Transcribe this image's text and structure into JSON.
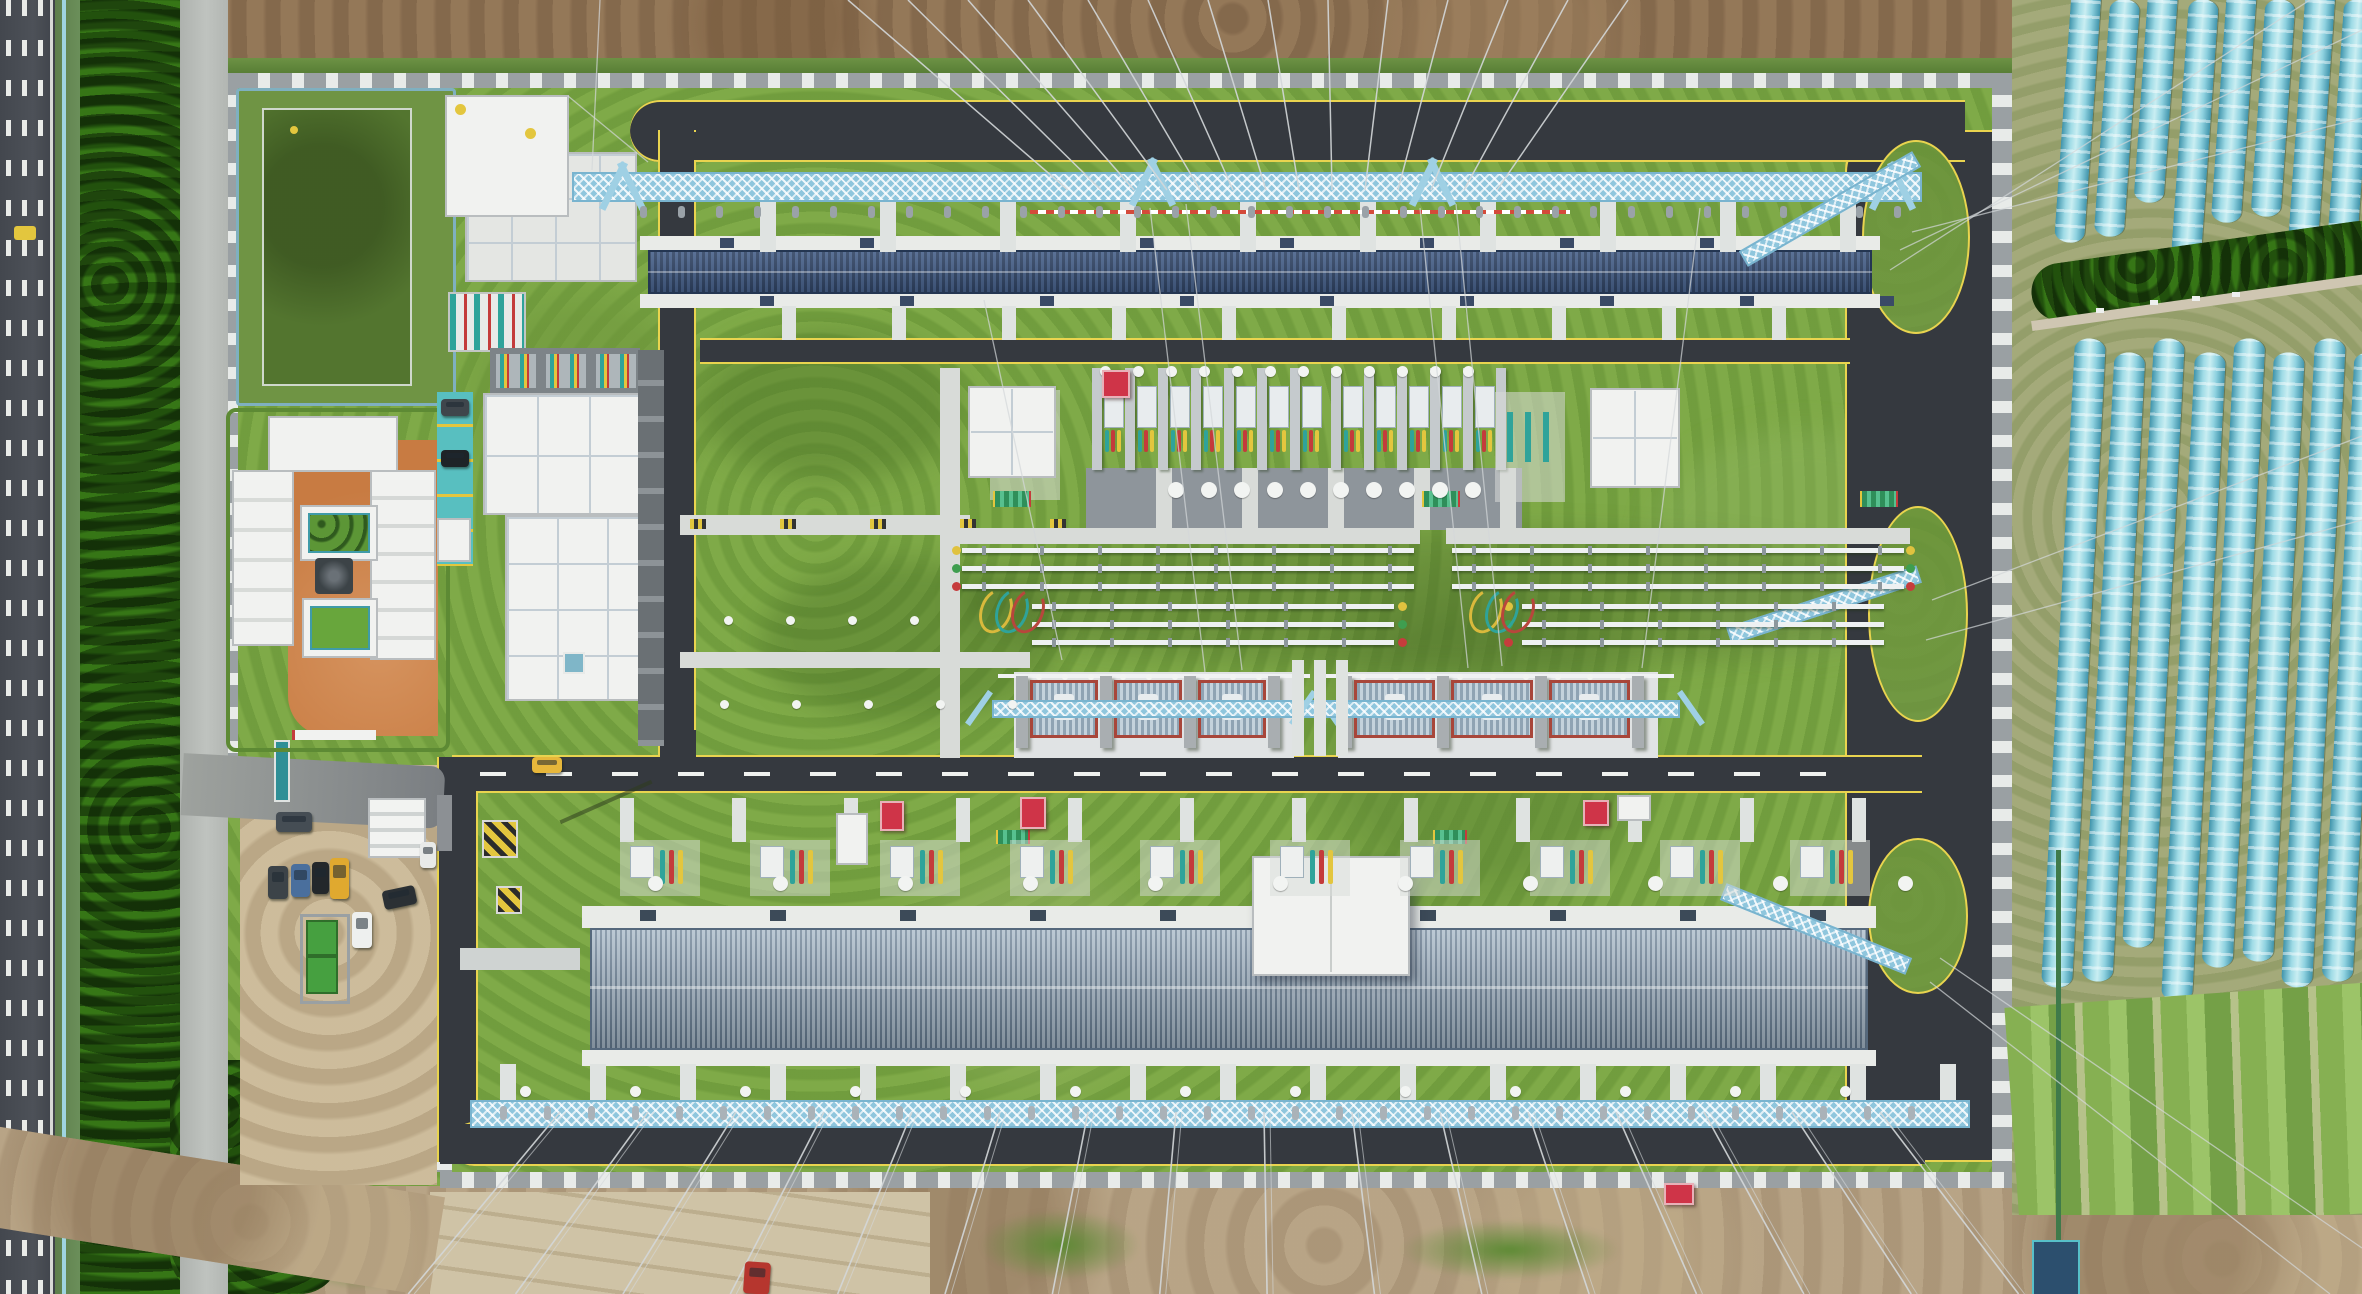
{
  "scene": {
    "type": "aerial-photograph",
    "subject": "top-down drone view of a high-voltage electrical substation compound",
    "surroundings": [
      "multi-lane highway with dashed lane markings (left)",
      "roadside tree belt",
      "light service road",
      "green retention pond",
      "courtyard staff building with two green garden pools",
      "gravel parking lot with vehicles",
      "rows of blue plastic greenhouse tunnels (right)",
      "bare earth construction ground (top and bottom)"
    ]
  },
  "palette": {
    "grass": "#7ca943",
    "asphalt": "#35393f",
    "highway": "#4a4e55",
    "curb_yellow": "#e9d44f",
    "concrete": "#d8dbd8",
    "white_roof": "#f1f2f0",
    "hall_roof_dark": "#3d5578",
    "hall_roof_light": "#8ea6ba",
    "gantry_blue": "#a8d8ea",
    "pond": "#53752f",
    "dirt_top": "#8f7355",
    "dirt_bottom": "#b5a184",
    "greenhouse": "#5fb9cf",
    "court_orange": "#c87b42",
    "parking_teal": "#58bfc0",
    "red_accent": "#cf3448",
    "busbar_white": "#eef1f2",
    "transformer_frame": "#a8463a",
    "radiator": "#9fb6c4",
    "field_green": "#86b052",
    "pool_green": "#5c9636",
    "dumpster_green": "#46a040"
  },
  "highway": {
    "dash_columns": [
      6,
      22,
      38
    ],
    "edge_line_x": 50,
    "yellow_marking": [
      14,
      226,
      22,
      14
    ]
  },
  "pond": {
    "enclosure": [
      236,
      88,
      214,
      312
    ],
    "water": [
      262,
      108,
      146,
      274
    ],
    "marker_dot": [
      290,
      126
    ]
  },
  "courtyard": {
    "ground": [
      288,
      440,
      150,
      296
    ],
    "building_top": [
      268,
      416,
      130,
      56
    ],
    "building_left": [
      232,
      470,
      58,
      172
    ],
    "building_right": [
      370,
      470,
      62,
      186
    ],
    "pool_upper": [
      300,
      505,
      74,
      52
    ],
    "pool_lower": [
      302,
      598,
      72,
      56
    ],
    "pavilion": [
      315,
      558,
      38,
      36
    ],
    "tree_dots_grid": [
      4,
      4
    ]
  },
  "teal_parking": {
    "rect": [
      437,
      392,
      36,
      174
    ],
    "lane_lines": 5
  },
  "office": {
    "roof_upper": [
      483,
      393,
      158,
      122
    ],
    "roof_lower": [
      505,
      515,
      150,
      186
    ],
    "east_wing": [
      638,
      350,
      26,
      396
    ],
    "rooftop_bays": 3,
    "bay_row": [
      490,
      348,
      150,
      46
    ],
    "skylight": [
      563,
      652,
      18,
      18
    ]
  },
  "admin_buildings": {
    "a": [
      445,
      95,
      124,
      122
    ],
    "b": [
      465,
      152,
      172,
      130
    ],
    "pad_c": [
      448,
      292,
      74,
      56
    ],
    "yellow_dots": [
      [
        455,
        104
      ],
      [
        525,
        128
      ]
    ]
  },
  "halls": {
    "upper": {
      "roof": [
        648,
        250,
        1224,
        44
      ],
      "band_top": [
        640,
        236,
        1240,
        14
      ],
      "band_bottom": [
        640,
        294,
        1240,
        14
      ]
    },
    "lower": {
      "roof": [
        590,
        928,
        1278,
        122
      ],
      "band_top": [
        582,
        906,
        1294,
        22
      ],
      "band_bottom": [
        582,
        1050,
        1294,
        16
      ],
      "penthouse": [
        1252,
        856,
        158,
        120
      ]
    }
  },
  "small_buildings": [
    [
      968,
      386,
      88,
      92
    ],
    [
      1590,
      388,
      90,
      100
    ]
  ],
  "switch_bays": {
    "count": 12,
    "x0": 1092,
    "step": 33,
    "y": 368,
    "divider_h": 102,
    "gap_after": 6,
    "cable_colors": [
      "#2fa39a",
      "#c43b3b",
      "#e3c63e"
    ],
    "circle_row_y": 482,
    "pad_y": 468,
    "pad_h": 62
  },
  "busbar_groups": [
    {
      "x": 962,
      "w": 452,
      "marker_side": "left"
    },
    {
      "x": 1452,
      "w": 452,
      "marker_side": "right"
    }
  ],
  "busbar": {
    "upper_ys": [
      548,
      566,
      584
    ],
    "lower_ys": [
      604,
      622,
      640
    ],
    "tube_h": 5,
    "marker_colors": [
      "#e0c23f",
      "#3f9e4f",
      "#c63c3c"
    ]
  },
  "transformer_banks": [
    {
      "x": 1028,
      "w": 252,
      "units": 3
    },
    {
      "x": 1352,
      "w": 292,
      "units": 3
    }
  ],
  "transformer": {
    "y": 672,
    "pad_h": 86,
    "unit_y": 680,
    "unit_h": 58,
    "duct_piers_x": [
      1292,
      1314,
      1336
    ]
  },
  "gantries": {
    "top": {
      "x": 572,
      "y": 172,
      "w": 1350,
      "h": 30
    },
    "bottom": {
      "x": 470,
      "y": 1100,
      "w": 1500,
      "h": 28
    },
    "island_trusses": [
      {
        "x": 1730,
        "y": 200,
        "len": 200,
        "rot": -30
      },
      {
        "x": 1724,
        "y": 596,
        "len": 200,
        "rot": -18
      },
      {
        "x": 1716,
        "y": 920,
        "len": 200,
        "rot": 22
      }
    ]
  },
  "grass_islands": [
    [
      1862,
      140,
      104,
      190
    ],
    [
      1868,
      506,
      96,
      212
    ],
    [
      1868,
      838,
      96,
      152
    ]
  ],
  "piers": {
    "rows": [
      {
        "y": 196,
        "h": 56,
        "x0": 760,
        "x1": 1900,
        "step": 120,
        "w": 16
      },
      {
        "y": 306,
        "h": 34,
        "x0": 782,
        "x1": 1880,
        "step": 110,
        "w": 14
      },
      {
        "y": 798,
        "h": 44,
        "x0": 620,
        "x1": 1900,
        "step": 112,
        "w": 14
      },
      {
        "y": 1064,
        "h": 38,
        "x0": 500,
        "x1": 1940,
        "step": 90,
        "w": 16
      }
    ]
  },
  "stones": {
    "rows": [
      {
        "y": 366,
        "x0": 1100,
        "x1": 1480,
        "step": 33,
        "d": 11
      },
      {
        "y": 482,
        "x0": 1168,
        "x1": 1470,
        "step": 33,
        "d": 16
      },
      {
        "y": 876,
        "x0": 648,
        "x1": 1900,
        "step": 125,
        "d": 15
      },
      {
        "y": 1086,
        "x0": 520,
        "x1": 1920,
        "step": 110,
        "d": 11
      },
      {
        "y": 616,
        "x0": 724,
        "x1": 950,
        "step": 62,
        "d": 9
      },
      {
        "y": 700,
        "x0": 720,
        "x1": 1010,
        "step": 72,
        "d": 9
      }
    ]
  },
  "power_lines": {
    "top_fan": {
      "count": 14,
      "x0_top": 848,
      "dx_top": 60,
      "x0_bot": 1068,
      "dx_bot": 33,
      "y_bot": 190
    },
    "bottom_fan": {
      "count": 16,
      "x0": 560,
      "dx": 88,
      "y_top": 1112,
      "center": 1250,
      "spread": 0.22
    },
    "extra": [
      [
        1900,
        250,
        2362,
        30
      ],
      [
        1890,
        270,
        2310,
        0
      ],
      [
        1912,
        232,
        2362,
        118
      ],
      [
        1932,
        600,
        2362,
        436
      ],
      [
        1926,
        640,
        2362,
        520
      ],
      [
        1940,
        958,
        2362,
        1248
      ],
      [
        1930,
        982,
        2330,
        1294
      ],
      [
        1150,
        208,
        1205,
        672
      ],
      [
        1186,
        204,
        1242,
        670
      ],
      [
        1420,
        208,
        1468,
        668
      ],
      [
        1456,
        204,
        1502,
        666
      ],
      [
        984,
        300,
        1062,
        660
      ],
      [
        1700,
        208,
        1642,
        668
      ],
      [
        568,
        96,
        648,
        162
      ],
      [
        600,
        0,
        592,
        170
      ]
    ]
  },
  "vehicles": [
    {
      "name": "yellow-car",
      "c": "#e7b73b",
      "r": [
        532,
        757,
        30,
        16
      ],
      "rot": 0
    },
    {
      "name": "gray-car",
      "c": "#454d54",
      "r": [
        276,
        812,
        36,
        20
      ],
      "rot": 0
    },
    {
      "name": "dark-car",
      "c": "#3c4348",
      "r": [
        268,
        866,
        20,
        33
      ],
      "rot": 0
    },
    {
      "name": "blue-car",
      "c": "#4a6f9d",
      "r": [
        291,
        864,
        19,
        33
      ],
      "rot": 0
    },
    {
      "name": "black-car",
      "c": "#23272b",
      "r": [
        312,
        862,
        17,
        32
      ],
      "rot": 0
    },
    {
      "name": "yellow-bus",
      "c": "#e0a92f",
      "r": [
        330,
        858,
        19,
        41
      ],
      "rot": 0
    },
    {
      "name": "black-car",
      "c": "#2b3034",
      "r": [
        383,
        888,
        33,
        19
      ],
      "rot": -12
    },
    {
      "name": "white-car",
      "c": "#eef0ef",
      "r": [
        352,
        912,
        20,
        36
      ],
      "rot": 0
    },
    {
      "name": "parked-car",
      "c": "#3f464c",
      "r": [
        441,
        399,
        28,
        17
      ],
      "rot": 0
    },
    {
      "name": "parked-car",
      "c": "#1e2327",
      "r": [
        441,
        450,
        28,
        17
      ],
      "rot": 0
    },
    {
      "name": "white-van",
      "c": "#e8eae8",
      "r": [
        420,
        842,
        16,
        26
      ],
      "rot": 0
    },
    {
      "name": "red-truck",
      "c": "#b6362e",
      "r": [
        744,
        1262,
        26,
        32
      ],
      "rot": 4
    }
  ],
  "dumpsters": [
    [
      306,
      920,
      28,
      32
    ],
    [
      306,
      956,
      28,
      34
    ]
  ],
  "red_boxes": [
    [
      1102,
      370,
      24,
      24
    ],
    [
      880,
      801,
      20,
      26
    ],
    [
      1020,
      797,
      22,
      28
    ],
    [
      1583,
      800,
      22,
      22
    ],
    [
      1664,
      1183,
      26,
      18
    ]
  ],
  "white_huts": [
    [
      836,
      813,
      32,
      52
    ],
    [
      1617,
      795,
      34,
      26
    ],
    [
      437,
      518,
      34,
      44
    ]
  ],
  "yellow_pads": [
    [
      482,
      820,
      36,
      38
    ],
    [
      496,
      886,
      26,
      28
    ]
  ],
  "racks": [
    [
      995,
      491,
      34,
      16
    ],
    [
      1424,
      491,
      34,
      16
    ],
    [
      1862,
      491,
      34,
      16
    ],
    [
      998,
      830,
      30,
      14
    ],
    [
      1435,
      830,
      30,
      14
    ]
  ],
  "walkway_ticks": {
    "y": 519,
    "x0": 690,
    "x1": 1050,
    "step": 90
  },
  "greenhouses": {
    "upper": {
      "x0": 2063,
      "y": -15,
      "step": 39,
      "w": 30,
      "h": 258,
      "count": 8,
      "tilt": 4
    },
    "lower": {
      "x0": 2058,
      "y": 338,
      "step": 40,
      "w": 31,
      "h": 650,
      "count": 8,
      "tilt": 3
    },
    "road_specks": [
      [
        2150,
        300
      ],
      [
        2192,
        296
      ],
      [
        2232,
        292
      ],
      [
        2096,
        308
      ]
    ]
  },
  "tarp_hut": [
    2032,
    1240,
    44,
    54
  ],
  "canopy": [
    368,
    798,
    54,
    56
  ]
}
